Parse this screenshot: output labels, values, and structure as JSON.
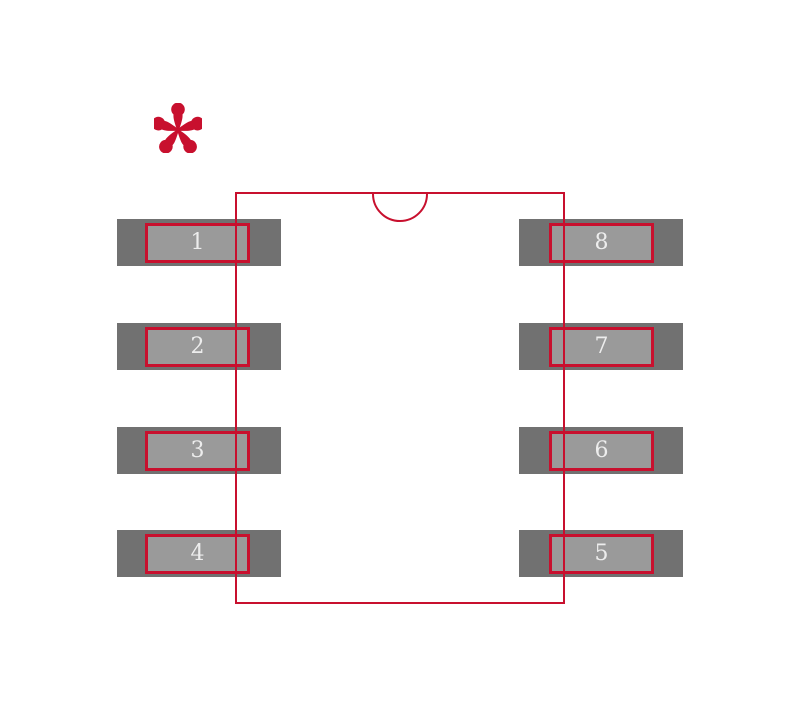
{
  "figure": {
    "description": "8-pad integrated-circuit footprint land pattern with package outline, pin-1 notch and pin-1 asterisk marker",
    "background": "#ffffff"
  },
  "colors": {
    "outline_red": "#C8102E",
    "pad_outer_gray": "#717171",
    "pad_inner_gray": "#9A9A9A",
    "pad_number_text": "#EDEDED"
  },
  "marker": {
    "glyph": "*",
    "name": "pin1-marker"
  },
  "pads": [
    {
      "number": "1",
      "side": "left",
      "row": 1
    },
    {
      "number": "2",
      "side": "left",
      "row": 2
    },
    {
      "number": "3",
      "side": "left",
      "row": 3
    },
    {
      "number": "4",
      "side": "left",
      "row": 4
    },
    {
      "number": "8",
      "side": "right",
      "row": 1
    },
    {
      "number": "7",
      "side": "right",
      "row": 2
    },
    {
      "number": "6",
      "side": "right",
      "row": 3
    },
    {
      "number": "5",
      "side": "right",
      "row": 4
    }
  ]
}
